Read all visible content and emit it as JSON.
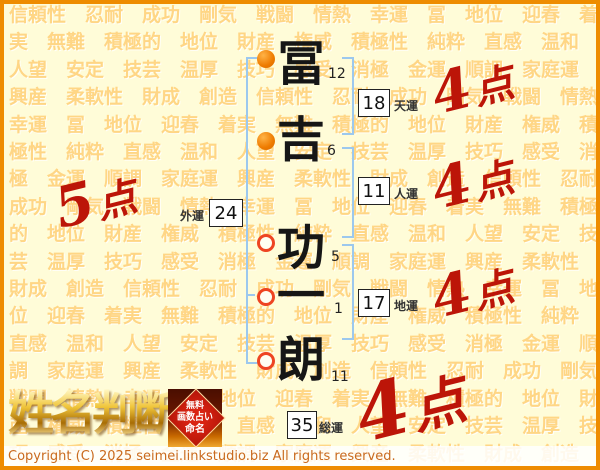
{
  "background": {
    "words": [
      "信頼性",
      "忍耐",
      "成功",
      "剛気",
      "戦闘",
      "情熱",
      "幸運",
      "冨",
      "地位",
      "迎春",
      "着実",
      "無難",
      "積極的",
      "地位",
      "財産",
      "権威",
      "積極性",
      "純粋",
      "直感",
      "温和",
      "人望",
      "安定",
      "技芸",
      "温厚",
      "技巧",
      "感受",
      "消極",
      "金運",
      "順調",
      "家庭運",
      "興産",
      "柔軟性",
      "財成",
      "創造"
    ],
    "repeat": 8
  },
  "name": {
    "surname": [
      {
        "char": "冨",
        "strokes": "12"
      },
      {
        "char": "吉",
        "strokes": "6"
      }
    ],
    "given": [
      {
        "char": "功",
        "strokes": "5"
      },
      {
        "char": "一",
        "strokes": "1"
      },
      {
        "char": "朗",
        "strokes": "11"
      }
    ]
  },
  "fortunes": {
    "tenun": {
      "label": "天運",
      "value": "18",
      "score_num": "4",
      "score_unit": "点"
    },
    "jinun": {
      "label": "人運",
      "value": "11",
      "score_num": "4",
      "score_unit": "点"
    },
    "gaiun": {
      "label": "外運",
      "value": "24",
      "score_num": "5",
      "score_unit": "点"
    },
    "chiun": {
      "label": "地運",
      "value": "17",
      "score_num": "4",
      "score_unit": "点"
    },
    "soun": {
      "label": "総運",
      "value": "35",
      "score_num": "4",
      "score_unit": "点"
    }
  },
  "logo": {
    "title": "姓名判断",
    "badge": {
      "line1": "無料",
      "line2": "画数占い",
      "line3": "命名"
    }
  },
  "footer": {
    "copyright": "Copyright (C) 2025 seimei.linkstudio.biz All rights reserved."
  },
  "colors": {
    "accent_red": "#bc1508",
    "bracket_blue": "#9cc8ee",
    "circle_orange": "#ee7b00",
    "frame_orange": "#ee8c00",
    "background_cream": "#fffcd8",
    "word_orange": "#ffd685"
  }
}
